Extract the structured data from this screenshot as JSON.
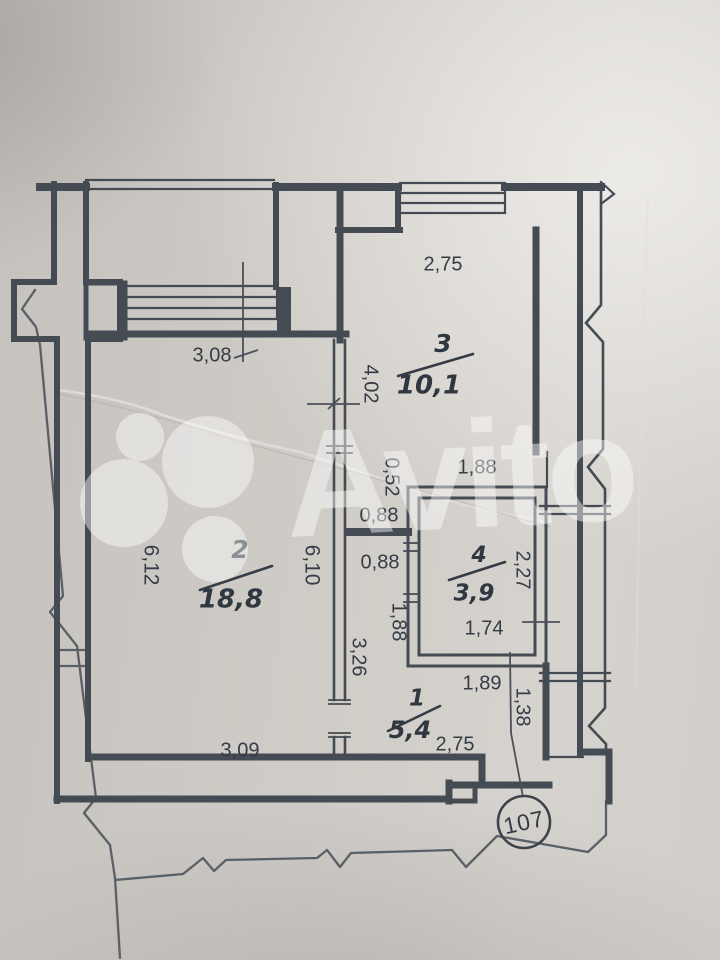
{
  "document": {
    "kind": "scanned apartment floor plan photograph",
    "apartment_number": "107"
  },
  "watermark": {
    "text": "Avito",
    "logo_icon": "avito-dots-logo"
  },
  "rooms": [
    {
      "number": "1",
      "area": "5,4"
    },
    {
      "number": "2",
      "area": "18,8"
    },
    {
      "number": "3",
      "area": "10,1"
    },
    {
      "number": "4",
      "area": "3,9"
    }
  ],
  "dimensions": {
    "room3_top_width": "2,75",
    "balcony_width": "3,08",
    "room3_left_height": "4,02",
    "corridor_stub": "0,52",
    "room4_top_width": "1,88",
    "lobby_width_upper": "0,88",
    "lobby_width_lower": "0,88",
    "corridor_segment": "1,88",
    "corridor_length": "3,26",
    "room2_left_height": "6,12",
    "room2_right_height": "6,10",
    "room4_right_height": "2,27",
    "room4_bottom_inner": "1,74",
    "room4_bottom_outer": "1,89",
    "entry_side": "1,38",
    "room2_bottom_width": "3,09",
    "room1_bottom_width": "2,75"
  },
  "colors": {
    "paper": "#cecac5",
    "wall": "#454b53",
    "thin_line": "#5a6067",
    "text": "#353c46",
    "watermark": "#ffffff"
  }
}
